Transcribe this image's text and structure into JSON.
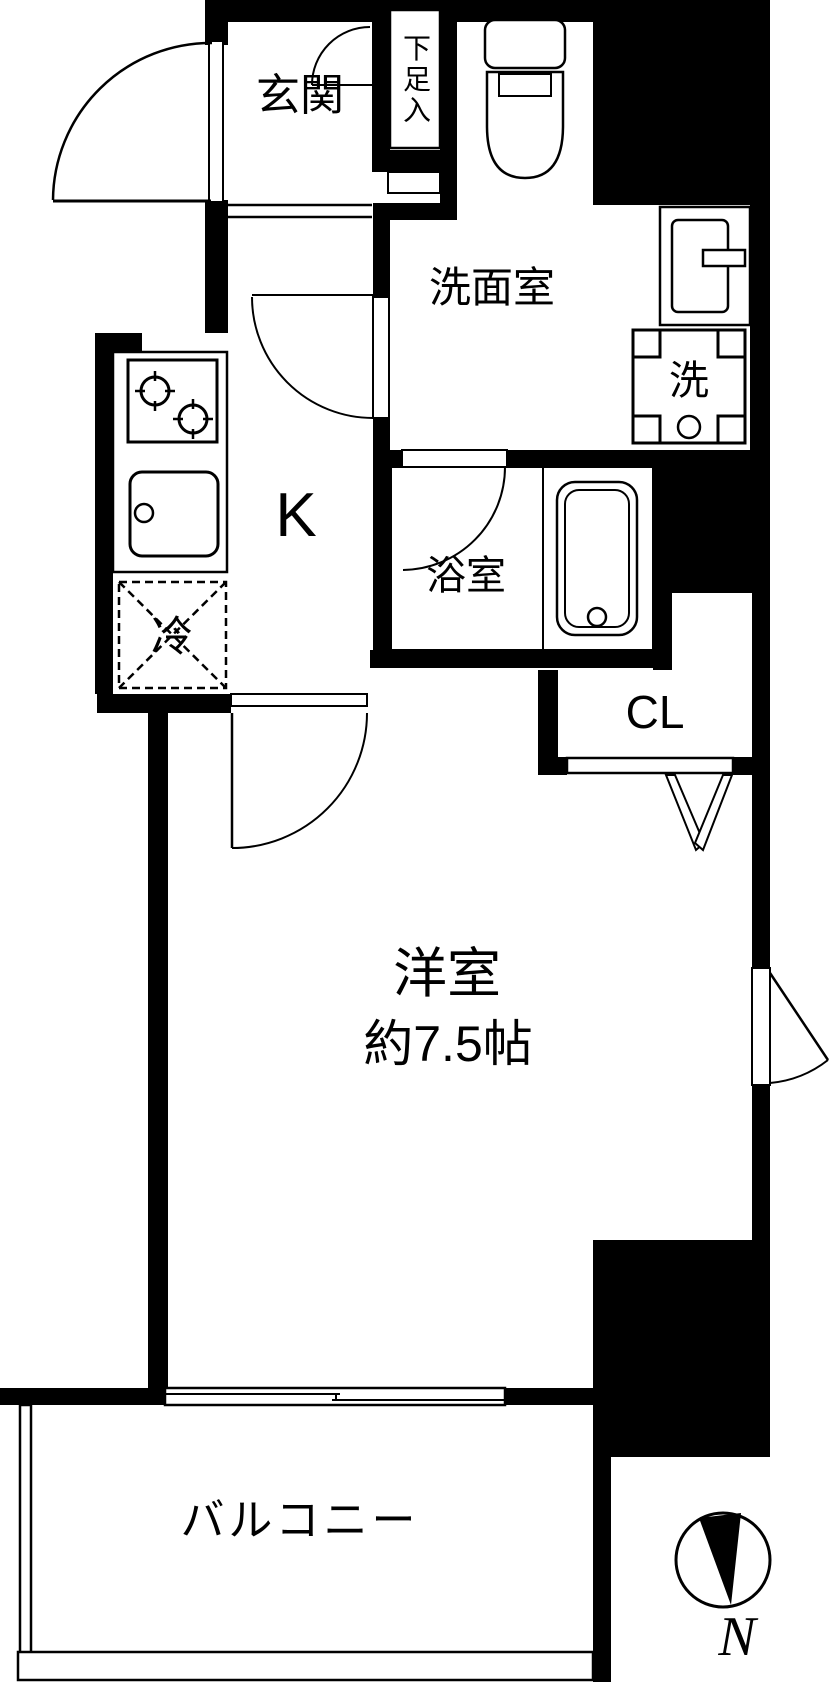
{
  "labels": {
    "genkan": "玄関",
    "shoe_cabinet": "下足入",
    "washroom": "洗面室",
    "kitchen": "K",
    "refrigerator": "冷",
    "bathroom": "浴室",
    "washer": "洗",
    "closet": "CL",
    "main_room": "洋室",
    "main_room_size": "約7.5帖",
    "balcony": "バルコニー",
    "compass_north": "N"
  },
  "colors": {
    "wall": "#000000",
    "floor": "#ffffff",
    "line": "#000000"
  }
}
